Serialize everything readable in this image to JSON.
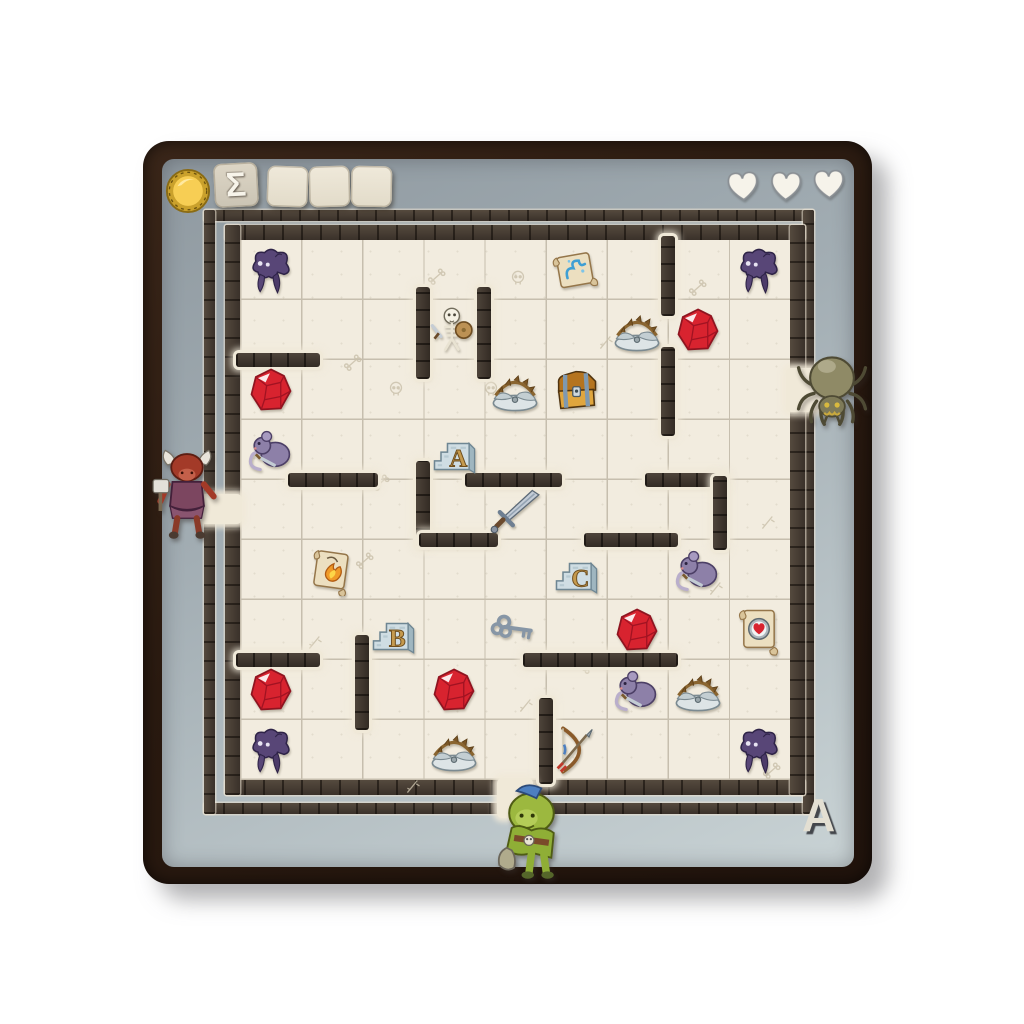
{
  "hud": {
    "coin_icon": "gold-coin",
    "sigma_label": "Σ",
    "score_boxes": 3,
    "hearts": 3
  },
  "corner_label": "A",
  "grid": {
    "rows": 9,
    "cols": 9,
    "origin_x": 240,
    "origin_y": 240,
    "cell_w": 61.1,
    "cell_h": 60
  },
  "items": [
    {
      "row": 1,
      "col": 1,
      "type": "shadow-monster"
    },
    {
      "row": 1,
      "col": 6,
      "type": "scroll-spell"
    },
    {
      "row": 1,
      "col": 9,
      "type": "shadow-monster"
    },
    {
      "row": 2,
      "col": 4,
      "type": "skeleton"
    },
    {
      "row": 2,
      "col": 7,
      "type": "bear-trap"
    },
    {
      "row": 2,
      "col": 8,
      "type": "gem"
    },
    {
      "row": 3,
      "col": 1,
      "type": "gem"
    },
    {
      "row": 3,
      "col": 5,
      "type": "bear-trap"
    },
    {
      "row": 3,
      "col": 6,
      "type": "treasure-chest"
    },
    {
      "row": 4,
      "col": 1,
      "type": "rat"
    },
    {
      "row": 4,
      "col": 4,
      "type": "block",
      "letter": "A"
    },
    {
      "row": 5,
      "col": 5,
      "type": "sword"
    },
    {
      "row": 6,
      "col": 2,
      "type": "scroll-fire"
    },
    {
      "row": 6,
      "col": 6,
      "type": "block",
      "letter": "C"
    },
    {
      "row": 6,
      "col": 8,
      "type": "rat"
    },
    {
      "row": 7,
      "col": 3,
      "type": "block",
      "letter": "B"
    },
    {
      "row": 7,
      "col": 5,
      "type": "key"
    },
    {
      "row": 7,
      "col": 7,
      "type": "gem"
    },
    {
      "row": 7,
      "col": 9,
      "type": "scroll-heart"
    },
    {
      "row": 8,
      "col": 1,
      "type": "gem"
    },
    {
      "row": 8,
      "col": 4,
      "type": "gem"
    },
    {
      "row": 8,
      "col": 7,
      "type": "rat"
    },
    {
      "row": 8,
      "col": 8,
      "type": "bear-trap"
    },
    {
      "row": 9,
      "col": 1,
      "type": "shadow-monster"
    },
    {
      "row": 9,
      "col": 4,
      "type": "bear-trap"
    },
    {
      "row": 9,
      "col": 6,
      "type": "bow"
    },
    {
      "row": 9,
      "col": 9,
      "type": "shadow-monster"
    }
  ],
  "walls": [
    {
      "dir": "h",
      "x": 0,
      "y": 2,
      "len": 1.25
    },
    {
      "dir": "v",
      "x": 3,
      "y": 0.85,
      "len": 1.4
    },
    {
      "dir": "v",
      "x": 4,
      "y": 0.85,
      "len": 1.4
    },
    {
      "dir": "v",
      "x": 7,
      "y": 0,
      "len": 1.2
    },
    {
      "dir": "v",
      "x": 7,
      "y": 1.85,
      "len": 1.35
    },
    {
      "dir": "h",
      "x": 0.85,
      "y": 4,
      "len": 1.35
    },
    {
      "dir": "h",
      "x": 3.75,
      "y": 4,
      "len": 1.45
    },
    {
      "dir": "v",
      "x": 3,
      "y": 3.75,
      "len": 1.3
    },
    {
      "dir": "h",
      "x": 3,
      "y": 5,
      "len": 1.15
    },
    {
      "dir": "h",
      "x": 6.7,
      "y": 4,
      "len": 1.2
    },
    {
      "dir": "v",
      "x": 7.85,
      "y": 4,
      "len": 1.1
    },
    {
      "dir": "h",
      "x": 5.7,
      "y": 5,
      "len": 1.4
    },
    {
      "dir": "h",
      "x": 4.7,
      "y": 7,
      "len": 2.4
    },
    {
      "dir": "v",
      "x": 2,
      "y": 6.65,
      "len": 1.45
    },
    {
      "dir": "h",
      "x": 0,
      "y": 7,
      "len": 1.25
    },
    {
      "dir": "v",
      "x": 5,
      "y": 7.7,
      "len": 1.3
    }
  ],
  "entrances": [
    {
      "side": "west",
      "row": 5,
      "character": "minotaur"
    },
    {
      "side": "east",
      "row": 3,
      "character": "spider"
    },
    {
      "side": "south",
      "col": 5,
      "character": "goblin"
    }
  ],
  "doodles": [
    {
      "x": 1.35,
      "y": 1.55,
      "kind": "monocle"
    },
    {
      "x": 2.05,
      "y": 2.0,
      "kind": "skull"
    },
    {
      "x": 2.72,
      "y": 0.12,
      "kind": "bones"
    },
    {
      "x": 4.05,
      "y": 0.15,
      "kind": "skull"
    },
    {
      "x": 7.0,
      "y": 0.3,
      "kind": "fishbone"
    },
    {
      "x": 5.5,
      "y": 1.2,
      "kind": "arrow"
    },
    {
      "x": 1.8,
      "y": 3.55,
      "kind": "bones"
    },
    {
      "x": 3.6,
      "y": 2.0,
      "kind": "skull"
    },
    {
      "x": 8.15,
      "y": 4.2,
      "kind": "lizard"
    },
    {
      "x": 0.75,
      "y": 6.2,
      "kind": "dagger"
    },
    {
      "x": 4.2,
      "y": 7.25,
      "kind": "feather"
    },
    {
      "x": 1.55,
      "y": 7.05,
      "kind": "skull"
    },
    {
      "x": 2.35,
      "y": 8.6,
      "kind": "sickle"
    },
    {
      "x": 8.2,
      "y": 8.35,
      "kind": "bone"
    },
    {
      "x": 5.25,
      "y": 6.6,
      "kind": "bone"
    },
    {
      "x": 7.3,
      "y": 5.3,
      "kind": "lizard"
    },
    {
      "x": 1.55,
      "y": 4.85,
      "kind": "bones"
    },
    {
      "x": 4.35,
      "y": 3.55,
      "kind": "skull"
    }
  ],
  "colors": {
    "page_bg": "#ffffff",
    "board_frame": "#2a1a10",
    "stone": "#a2adb3",
    "floor": "#f2ecdf",
    "grid_line": "#c6beae",
    "wall_brick": "#4e443a",
    "gem_red": "#d8232f",
    "letter_gold": "#c59a4e",
    "heart_fill": "#f6f3ea",
    "coin_gold": "#f7ce54",
    "monster_purple": "#584677",
    "rat_purple": "#8d80a8"
  }
}
